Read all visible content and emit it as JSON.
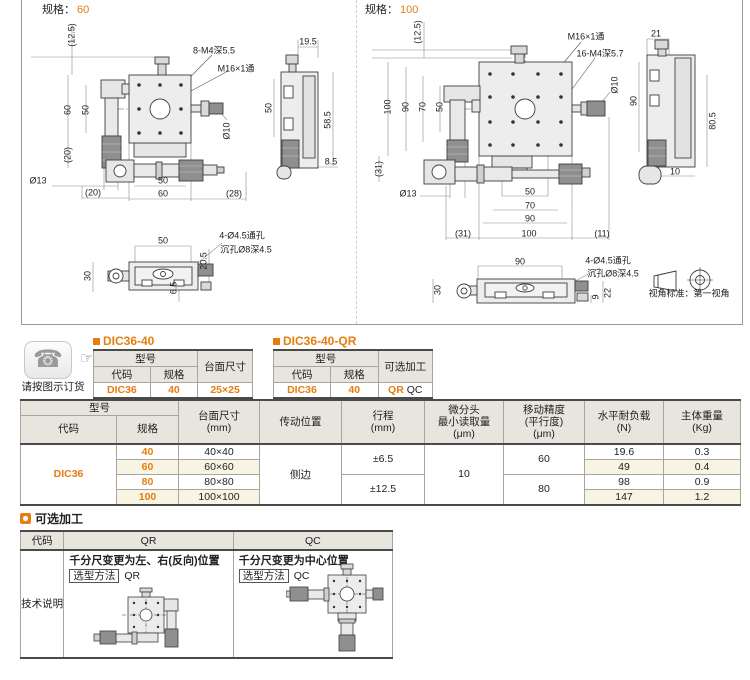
{
  "accent": "#e67d0e",
  "icons": {
    "phone": "☎",
    "hand": "☞"
  },
  "order_note": "请按图示订货",
  "spec60": {
    "section_label": "规格：",
    "section_value": "60",
    "dims": {
      "h12_5": "(12.5)",
      "note_m4": "8-M4深5.5",
      "note_m16": "M16×1通",
      "side_w": "19.5",
      "f60": "60",
      "f50": "50",
      "f20": "(20)",
      "side50": "50",
      "side58_5": "58.5",
      "side8_5": "8.5",
      "dia10": "Ø10",
      "dia13": "Ø13",
      "b20": "(20)",
      "b50": "50",
      "b60": "60",
      "b28": "(28)",
      "bv50": "50",
      "holes1": "4-Ø4.5通孔",
      "holes2": "沉孔Ø8深4.5",
      "bv30": "30",
      "bv20_5": "20.5",
      "bv6_5": "6.5"
    }
  },
  "spec100": {
    "section_label": "规格：",
    "section_value": "100",
    "view_standard": "视角标准：第一视角",
    "dims": {
      "h12_5": "(12.5)",
      "note_m16": "M16×1通",
      "note_m4": "16-M4深5.7",
      "side_w": "21",
      "f100": "100",
      "f90": "90",
      "f70": "70",
      "f50": "50",
      "f31": "(31)",
      "dia10": "Ø10",
      "side90": "90",
      "side80_5": "80.5",
      "side10": "10",
      "dia13": "Ø13",
      "b50": "50",
      "b70": "70",
      "b90": "90",
      "b31": "(31)",
      "b100": "100",
      "b11": "(11)",
      "bv90": "90",
      "holes1": "4-Ø4.5通孔",
      "holes2": "沉孔Ø8深4.5",
      "bv30": "30",
      "bv9": "9",
      "bv22": "22"
    }
  },
  "model_table_1": {
    "title": "DIC36-40",
    "group_header": "型号",
    "col_code": "代码",
    "col_spec": "规格",
    "col_extra": "台面尺寸",
    "val_code": "DIC36",
    "val_spec": "40",
    "val_extra": "25×25"
  },
  "model_table_2": {
    "title": "DIC36-40-QR",
    "group_header": "型号",
    "col_code": "代码",
    "col_spec": "规格",
    "col_extra": "可选加工",
    "val_code": "DIC36",
    "val_spec": "40",
    "val_extra_1": "QR",
    "val_extra_2": "QC"
  },
  "spec_table": {
    "h_model": "型号",
    "h_code": "代码",
    "h_spec": "规格",
    "h_size_1": "台面尺寸",
    "h_size_2": "(mm)",
    "h_drive": "传动位置",
    "h_travel_1": "行程",
    "h_travel_2": "(mm)",
    "h_micro_1": "微分头",
    "h_micro_2": "最小读取量",
    "h_micro_3": "(μm)",
    "h_acc_1": "移动精度",
    "h_acc_2": "(平行度)",
    "h_acc_3": "(μm)",
    "h_load_1": "水平耐负载",
    "h_load_2": "(N)",
    "h_weight_1": "主体重量",
    "h_weight_2": "(Kg)",
    "code": "DIC36",
    "drive": "侧边",
    "micro_reading": "10",
    "travel_a": "±6.5",
    "travel_b": "±12.5",
    "acc_a": "60",
    "acc_b": "80",
    "rows": [
      {
        "spec": "40",
        "size": "40×40",
        "load": "19.6",
        "weight": "0.3"
      },
      {
        "spec": "60",
        "size": "60×60",
        "load": "49",
        "weight": "0.4"
      },
      {
        "spec": "80",
        "size": "80×80",
        "load": "98",
        "weight": "0.9"
      },
      {
        "spec": "100",
        "size": "100×100",
        "load": "147",
        "weight": "1.2"
      }
    ]
  },
  "optional": {
    "title": "可选加工",
    "h_code": "代码",
    "h_qr": "QR",
    "h_qc": "QC",
    "row_label": "技术说明",
    "qr_desc": "千分尺变更为左、右(反向)位置",
    "qr_method_label": "选型方法",
    "qr_method_value": "QR",
    "qc_desc": "千分尺变更为中心位置",
    "qc_method_label": "选型方法",
    "qc_method_value": "QC"
  }
}
